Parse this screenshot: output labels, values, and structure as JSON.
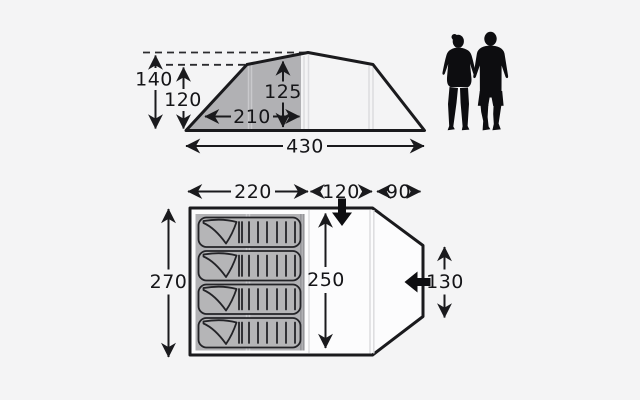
{
  "page": {
    "name": "Tent dimensions diagram"
  },
  "side_view": {
    "peak_height_cm": "140",
    "shoulder_height_cm": "120",
    "bedroom_height_cm": "125",
    "bedroom_length_cm": "210",
    "total_length_cm": "430"
  },
  "floor_plan": {
    "bedroom_width_cm": "220",
    "living_area_width_cm": "120",
    "canopy_width_cm": "90",
    "total_depth_cm": "270",
    "inner_depth_cm": "250",
    "front_door_width_cm": "130"
  },
  "colors": {
    "background": "#f4f4f5",
    "outline": "#1a1a1d",
    "shaded_area": "#b1b1b4",
    "silhouette": "#0d0d10"
  },
  "icons": {
    "top_entrance": "entrance-arrow-down-icon",
    "front_entrance": "entrance-arrow-left-icon",
    "scale_figures": "adult-couple-silhouette"
  }
}
